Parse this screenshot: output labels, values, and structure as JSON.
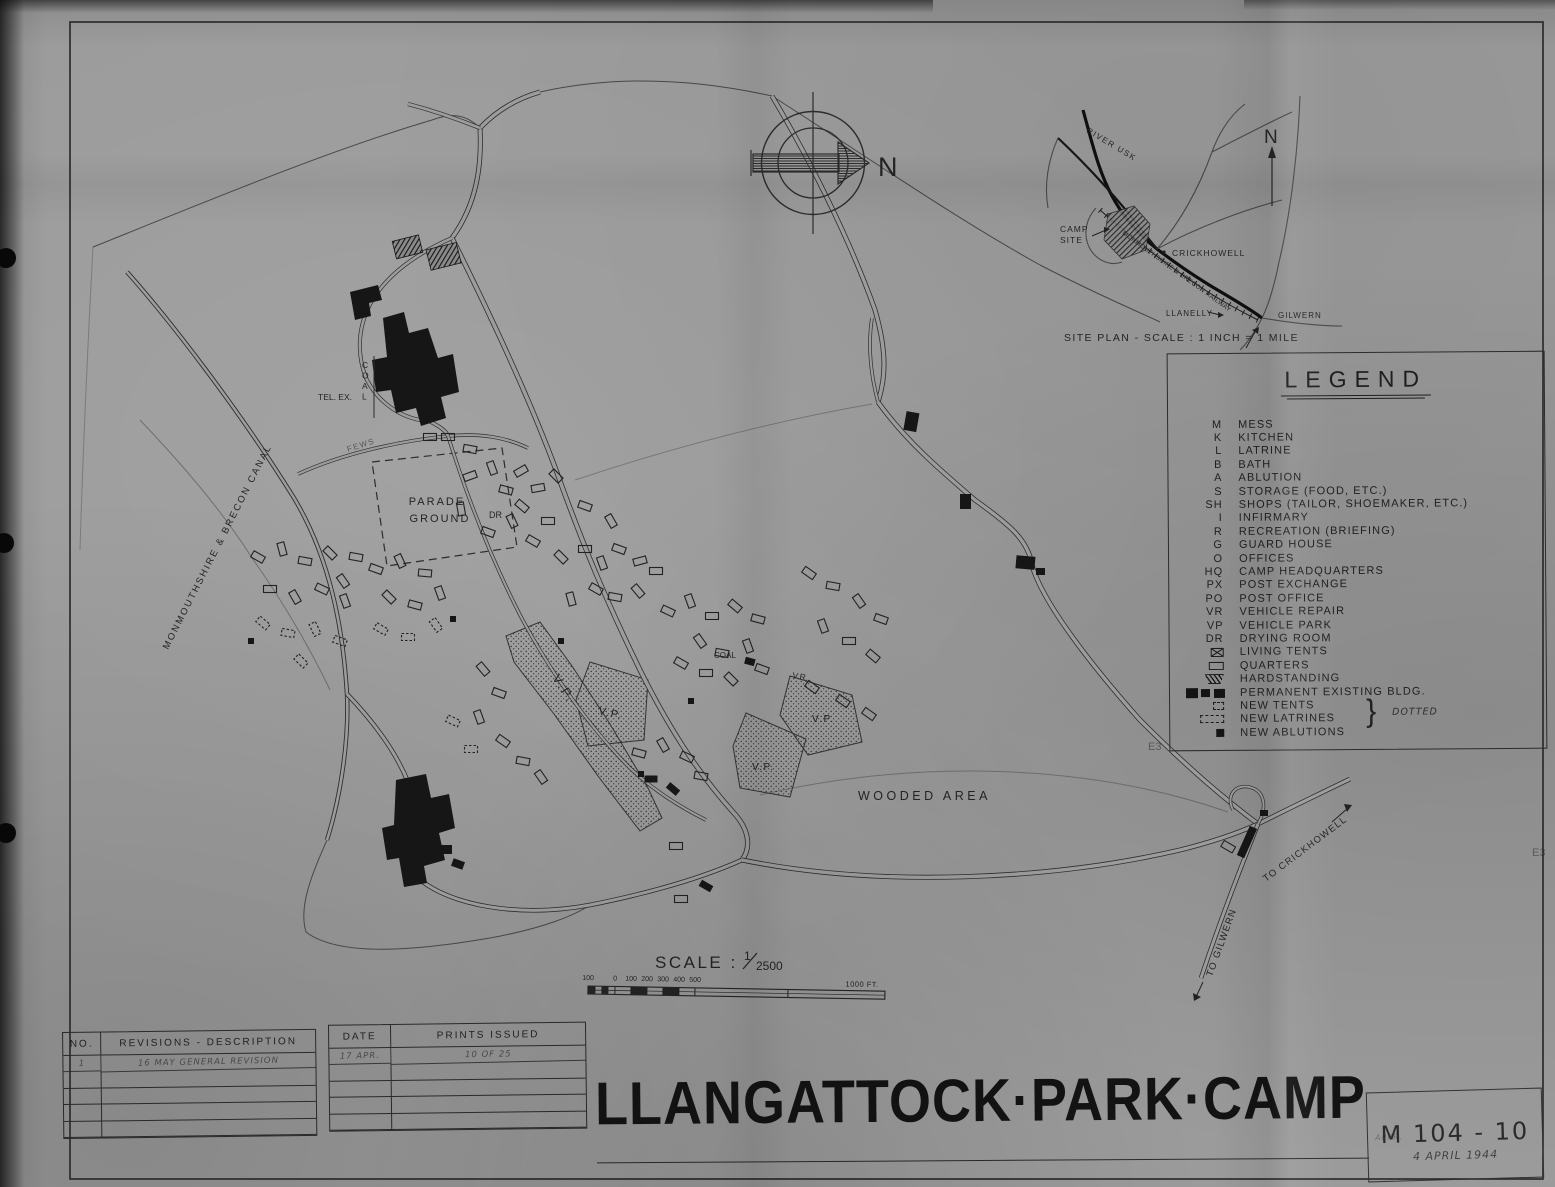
{
  "sheet": {
    "title": "LLANGATTOCK·PARK·CAMP"
  },
  "title_block": {
    "drawing_number": "M 104 - 10",
    "date": "4 APRIL 1944",
    "approved_label": "APPR."
  },
  "compass": {
    "north": "N"
  },
  "inset": {
    "caption": "SITE PLAN - SCALE : 1 INCH = 1 MILE",
    "north": "N",
    "labels": {
      "river": "RIVER USK",
      "crickhowell": "CRICKHOWELL",
      "camp_site_line1": "CAMP",
      "camp_site_line2": "SITE",
      "railway": "MONMOUTHSHIRE & BRECON RAILWAY",
      "llanelly": "LLANELLY",
      "gilwern": "GILWERN"
    }
  },
  "legend": {
    "title": "LEGEND",
    "dotted_note": "DOTTED",
    "items": [
      {
        "code": "M",
        "label": "MESS",
        "symbol": "text"
      },
      {
        "code": "K",
        "label": "KITCHEN",
        "symbol": "text"
      },
      {
        "code": "L",
        "label": "LATRINE",
        "symbol": "text"
      },
      {
        "code": "B",
        "label": "BATH",
        "symbol": "text"
      },
      {
        "code": "A",
        "label": "ABLUTION",
        "symbol": "text"
      },
      {
        "code": "S",
        "label": "STORAGE (FOOD, ETC.)",
        "symbol": "text"
      },
      {
        "code": "SH",
        "label": "SHOPS (TAILOR, SHOEMAKER, ETC.)",
        "symbol": "text"
      },
      {
        "code": "I",
        "label": "INFIRMARY",
        "symbol": "text"
      },
      {
        "code": "R",
        "label": "RECREATION (BRIEFING)",
        "symbol": "text"
      },
      {
        "code": "G",
        "label": "GUARD HOUSE",
        "symbol": "text"
      },
      {
        "code": "O",
        "label": "OFFICES",
        "symbol": "text"
      },
      {
        "code": "HQ",
        "label": "CAMP HEADQUARTERS",
        "symbol": "text"
      },
      {
        "code": "PX",
        "label": "POST EXCHANGE",
        "symbol": "text"
      },
      {
        "code": "PO",
        "label": "POST OFFICE",
        "symbol": "text"
      },
      {
        "code": "VR",
        "label": "VEHICLE REPAIR",
        "symbol": "text"
      },
      {
        "code": "VP",
        "label": "VEHICLE PARK",
        "symbol": "text"
      },
      {
        "code": "DR",
        "label": "DRYING ROOM",
        "symbol": "text"
      },
      {
        "code": "",
        "label": "LIVING TENTS",
        "symbol": "living-tents"
      },
      {
        "code": "",
        "label": "QUARTERS",
        "symbol": "quarters"
      },
      {
        "code": "",
        "label": "HARDSTANDING",
        "symbol": "hardstanding"
      },
      {
        "code": "",
        "label": "PERMANENT EXISTING BLDG.",
        "symbol": "permanent-bldg"
      },
      {
        "code": "",
        "label": "NEW TENTS",
        "symbol": "new-tents"
      },
      {
        "code": "",
        "label": "NEW LATRINES",
        "symbol": "new-latrines"
      },
      {
        "code": "",
        "label": "NEW ABLUTIONS",
        "symbol": "new-ablutions"
      }
    ]
  },
  "map_labels": {
    "canal": "MONMOUTHSHIRE & BRECON CANAL",
    "parade_line1": "PARADE",
    "parade_line2": "GROUND",
    "dr": "DR",
    "fews": "FEWS",
    "coal_vertical": "COAL",
    "tel_ex": "TEL. EX.",
    "coal": "COAL",
    "vp": "V.P.",
    "vr": "V.R.",
    "wooded": "WOODED AREA",
    "to_crickhowell": "TO CRICKHOWELL",
    "to_gilwern": "TO GILWERN"
  },
  "scale": {
    "prefix": "SCALE :",
    "numerator": "1",
    "denominator": "2500",
    "ticks": [
      "100",
      "0",
      "100",
      "200",
      "300",
      "400",
      "500"
    ],
    "end_label": "1000 FT."
  },
  "revisions_table": {
    "headers": [
      "NO.",
      "REVISIONS - DESCRIPTION",
      "DATE",
      "PRINTS ISSUED"
    ],
    "rows": [
      {
        "no": "1",
        "description": "16 MAY GENERAL REVISION",
        "date": "17 APR.",
        "prints": "10 OF 25"
      },
      {
        "no": "",
        "description": "",
        "date": "",
        "prints": ""
      },
      {
        "no": "",
        "description": "",
        "date": "",
        "prints": ""
      },
      {
        "no": "",
        "description": "",
        "date": "",
        "prints": ""
      },
      {
        "no": "",
        "description": "",
        "date": "",
        "prints": ""
      }
    ]
  },
  "annotations": {
    "pencil_mark": "E3"
  }
}
